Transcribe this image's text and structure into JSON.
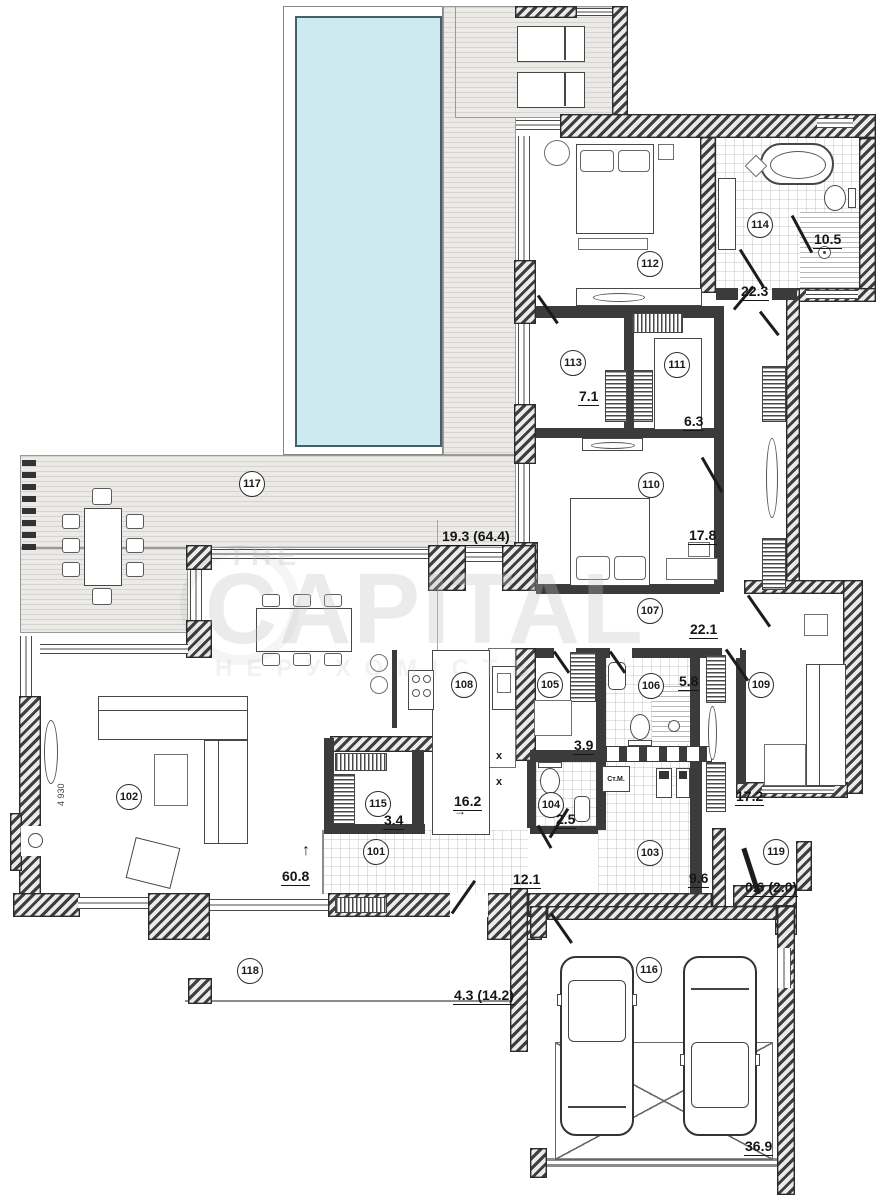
{
  "watermark": {
    "top": "THE",
    "main": "CAPITAL",
    "sub": "НЕРУХОМІСТЬ"
  },
  "rooms": [
    {
      "num": "101",
      "area": "12.1"
    },
    {
      "num": "102",
      "area": "60.8"
    },
    {
      "num": "103",
      "area": "9.6"
    },
    {
      "num": "104",
      "area": "2.5"
    },
    {
      "num": "105",
      "area": "3.9"
    },
    {
      "num": "106",
      "area": "5.8"
    },
    {
      "num": "107",
      "area": "22.1"
    },
    {
      "num": "108",
      "area": "16.2"
    },
    {
      "num": "109",
      "area": "17.2"
    },
    {
      "num": "110",
      "area": "17.8"
    },
    {
      "num": "111",
      "area": "6.3"
    },
    {
      "num": "112",
      "area": "22.3"
    },
    {
      "num": "113",
      "area": "7.1"
    },
    {
      "num": "114",
      "area": "10.5"
    },
    {
      "num": "115",
      "area": "3.4"
    },
    {
      "num": "116",
      "area": "36.9"
    },
    {
      "num": "117",
      "area": "19.3 (64.4)"
    },
    {
      "num": "118",
      "area": "4.3 (14.2)"
    },
    {
      "num": "119",
      "area": "0.6 (2.0)"
    }
  ],
  "annotations": {
    "washing_machine_label": "Ст.М.",
    "dimension": "4 930",
    "cross_mark": "x",
    "arrow_up": "↑",
    "arrow_right": "→"
  },
  "colors": {
    "pool_fill": "#cfe9f1",
    "deck_base": "#eceae7",
    "wall_hatch": "#3e3e3e"
  }
}
